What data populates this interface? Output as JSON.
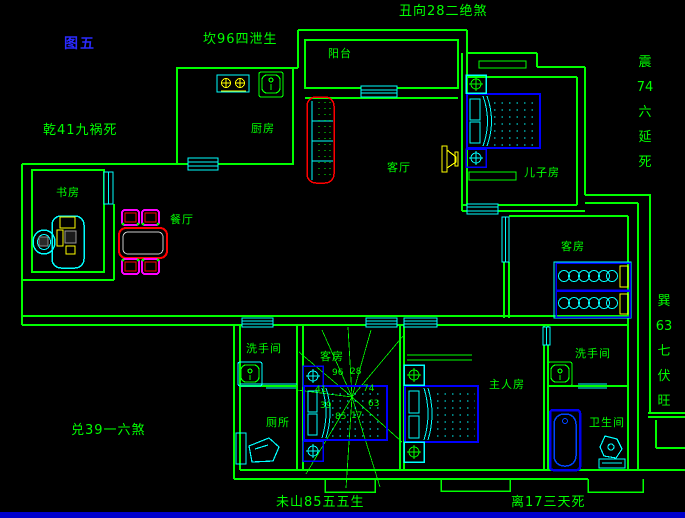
{
  "figure": {
    "label": "图五"
  },
  "perimeter": {
    "top": {
      "text": "丑向28二绝煞"
    },
    "top_left": {
      "text": "坎96四泄生"
    },
    "left_upper": {
      "text": "乾41九祸死"
    },
    "left_lower": {
      "text": "兑39一六煞"
    },
    "bottom_left": {
      "text": "未山85五五生"
    },
    "bottom_right": {
      "text": "离17三天死"
    },
    "right_upper": {
      "text": "震74六延死",
      "chars": [
        "震",
        "74",
        "六",
        "延",
        "死"
      ]
    },
    "right_lower": {
      "text": "巽63七伏旺",
      "chars": [
        "巽",
        "63",
        "七",
        "伏",
        "旺"
      ]
    }
  },
  "rooms": {
    "balcony": "阳台",
    "kitchen": "厨房",
    "living_room": "客厅",
    "son_room": "儿子房",
    "study": "书房",
    "dining_room": "餐厅",
    "guest_room_right": "客房",
    "guest_room_mid": "客房",
    "washroom_mid": "洗手间",
    "toilet": "厕所",
    "master_room": "主人房",
    "washroom_right": "洗手间",
    "bathroom": "卫生间"
  },
  "compass": {
    "values": [
      "96",
      "28",
      "41",
      "74",
      "39",
      "63",
      "85",
      "17"
    ]
  },
  "colors": {
    "wall_green": "#00ff00",
    "window_cyan": "#00ffff",
    "furniture_blue": "#0000ff",
    "accent_yellow": "#ffff00",
    "accent_red": "#ff0000",
    "accent_magenta": "#ff00ff",
    "figure_blue": "#2a2aff",
    "bottom_strip": "#0000cc",
    "background": "#000000"
  }
}
